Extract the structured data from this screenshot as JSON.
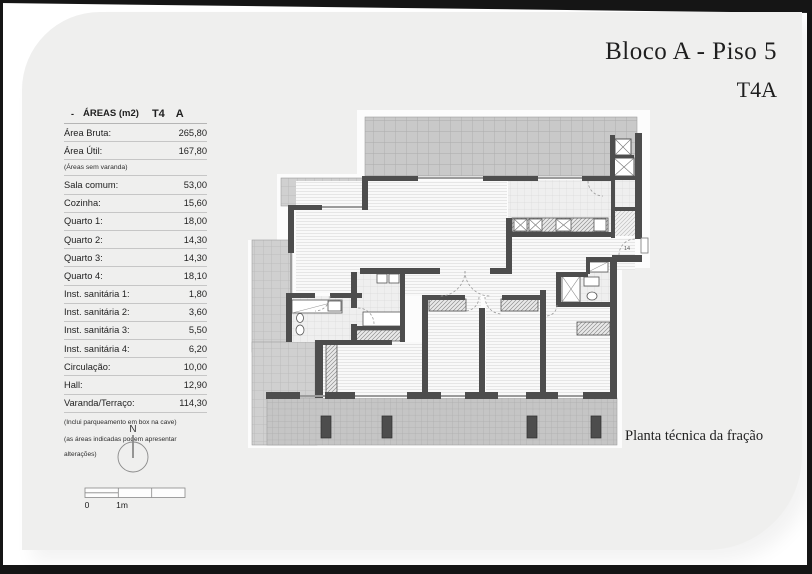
{
  "header": {
    "title": "Bloco A - Piso 5",
    "subtitle": "T4A"
  },
  "areas_table": {
    "head": {
      "dash": "-",
      "title": "ÁREAS (m2)",
      "col1": "T4",
      "col2": "A"
    },
    "rows_top": [
      {
        "label": "Área Bruta:",
        "value": "265,80"
      },
      {
        "label": "Área Útil:",
        "value": "167,80"
      }
    ],
    "varanda_note": "(Áreas sem varanda)",
    "rows": [
      {
        "label": "Sala comum:",
        "value": "53,00"
      },
      {
        "label": "Cozinha:",
        "value": "15,60"
      },
      {
        "label": "Quarto 1:",
        "value": "18,00"
      },
      {
        "label": "Quarto 2:",
        "value": "14,30"
      },
      {
        "label": "Quarto 3:",
        "value": "14,30"
      },
      {
        "label": "Quarto 4:",
        "value": "18,10"
      },
      {
        "label": "Inst. sanitária 1:",
        "value": "1,80"
      },
      {
        "label": "Inst. sanitária 2:",
        "value": "3,60"
      },
      {
        "label": "Inst. sanitária 3:",
        "value": "5,50"
      },
      {
        "label": "Inst. sanitária 4:",
        "value": "6,20"
      },
      {
        "label": "Circulação:",
        "value": "10,00"
      },
      {
        "label": "Hall:",
        "value": "12,90"
      },
      {
        "label": "Varanda/Terraço:",
        "value": "114,30"
      }
    ],
    "footnote1": "(Inclui parqueamento em box na cave)",
    "footnote2": "(as áreas indicadas podem apresentar alterações)"
  },
  "compass": {
    "label": "N"
  },
  "scale_bar": {
    "zero_label": "0",
    "one_label": "1m"
  },
  "plan": {
    "caption": "Planta técnica da fração",
    "entry_door_label": "14"
  },
  "colors": {
    "wall": "#4d4d4d",
    "pillar": "#4d4d4d",
    "terrace_fill": "#c9c9c9",
    "sheet": "#efefee",
    "text": "#1f1f1f"
  }
}
